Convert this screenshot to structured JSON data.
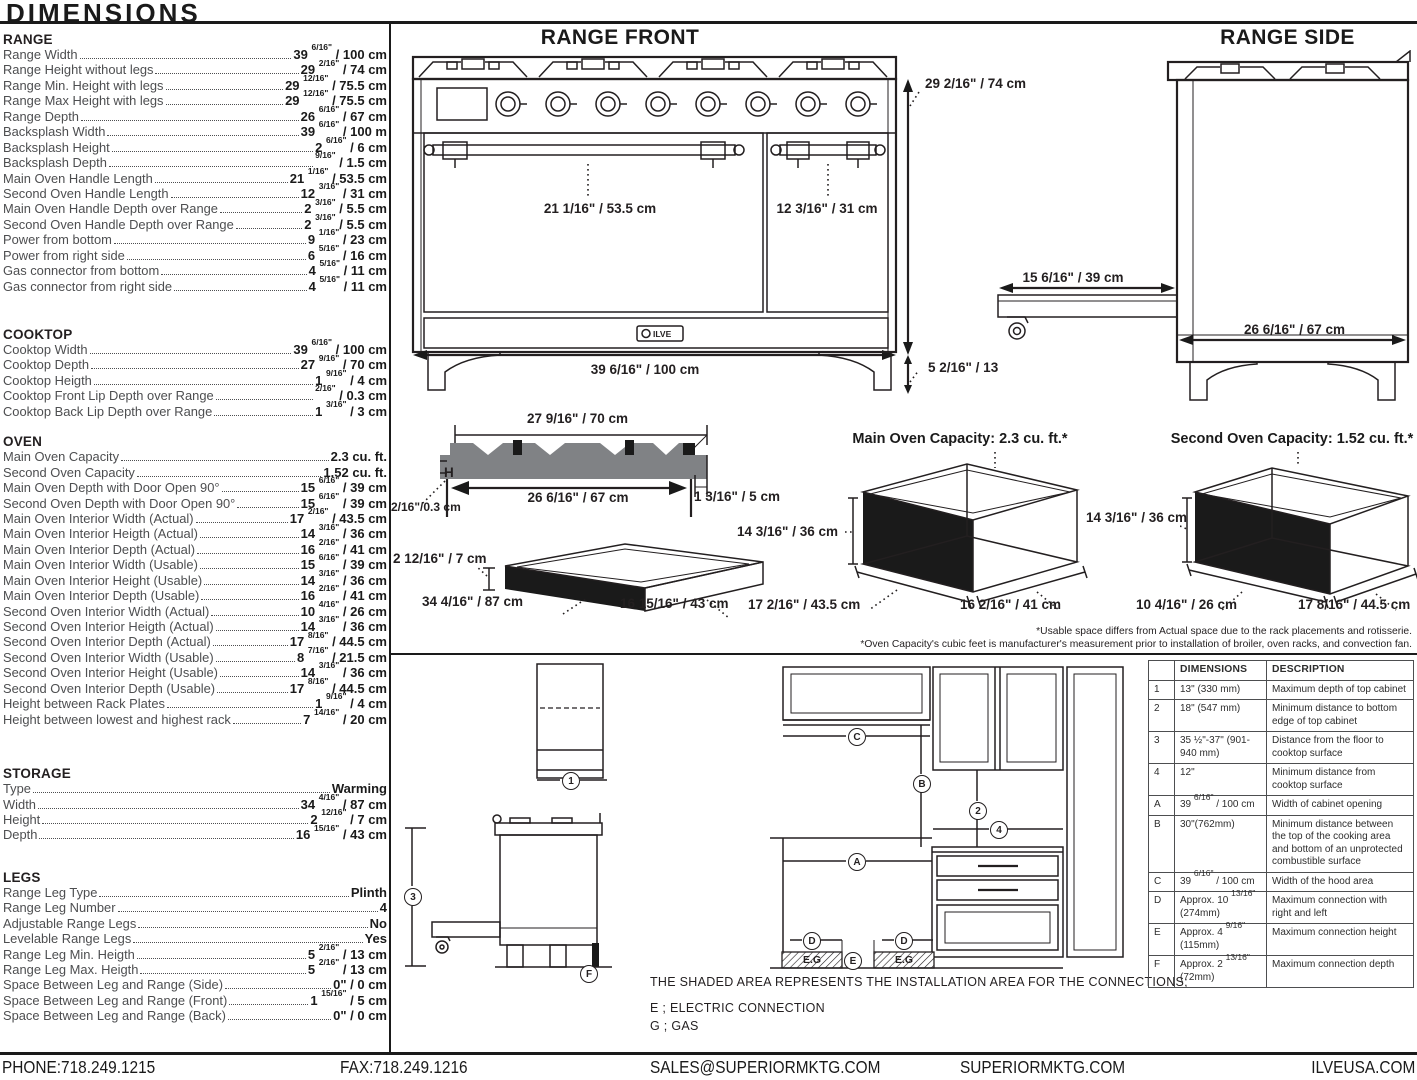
{
  "page_title": "DIMENSIONS",
  "colors": {
    "ink": "#231f20",
    "gray": "#58595b",
    "mid_gray": "#808285"
  },
  "logo": "ILVE",
  "sections": [
    {
      "heading": "RANGE",
      "rows": [
        [
          "Range Width",
          "39 6/16\" / 100 cm"
        ],
        [
          "Range Height without legs",
          "29 2/16\" / 74 cm"
        ],
        [
          "Range Min. Height with legs",
          "29 12/16\" / 75.5 cm"
        ],
        [
          "Range Max Height with legs",
          "29 12/16\" / 75.5 cm"
        ],
        [
          "Range Depth",
          "26 6/16\" / 67 cm"
        ],
        [
          "Backsplash Width",
          "39 6/16\" / 100 m"
        ],
        [
          "Backsplash Height",
          "2 6/16\" / 6 cm"
        ],
        [
          "Backsplash Depth",
          "9/16\" / 1.5 cm"
        ],
        [
          "Main Oven Handle Length",
          "21 1/16\" / 53.5 cm"
        ],
        [
          "Second Oven Handle Length",
          "12 3/16\" / 31 cm"
        ],
        [
          "Main Oven Handle Depth over Range",
          "2 3/16\" / 5.5 cm"
        ],
        [
          "Second Oven Handle Depth over Range",
          "2 3/16\" / 5.5 cm"
        ],
        [
          "Power from bottom",
          "9 1/16\" / 23 cm"
        ],
        [
          "Power from right side",
          "6 5/16\" / 16 cm"
        ],
        [
          "Gas connector from bottom",
          "4 5/16\" / 11 cm"
        ],
        [
          "Gas connector from right side",
          "4 5/16\" / 11 cm"
        ]
      ]
    },
    {
      "heading": "COOKTOP",
      "rows": [
        [
          "Cooktop Width",
          "39 6/16\" / 100 cm"
        ],
        [
          "Cooktop Depth",
          "27 9/16\" / 70 cm"
        ],
        [
          "Cooktop Heigth",
          "1 9/16\" / 4 cm"
        ],
        [
          "Cooktop Front Lip Depth over Range",
          "2/16\" / 0.3 cm"
        ],
        [
          "Cooktop Back Lip Depth over Range",
          "1 3/16\" / 3 cm"
        ]
      ]
    },
    {
      "heading": "OVEN",
      "rows": [
        [
          "Main Oven Capacity",
          "2.3 cu. ft."
        ],
        [
          "Second Oven Capacity",
          "1.52 cu. ft."
        ],
        [
          "Main Oven Depth with Door Open 90°",
          "15 6/16\" / 39 cm"
        ],
        [
          "Second Oven Depth with Door Open 90°",
          "15 6/16\" / 39 cm"
        ],
        [
          "Main Oven Interior Width (Actual)",
          "17 2/16\" / 43.5 cm"
        ],
        [
          "Main Oven Interior Heigth (Actual)",
          "14 3/16\" / 36 cm"
        ],
        [
          "Main Oven Interior Depth (Actual)",
          "16 2/16\" / 41 cm"
        ],
        [
          "Main Oven Interior Width (Usable)",
          "15 6/16\" / 39 cm"
        ],
        [
          "Main Oven Interior Height (Usable)",
          "14 3/16\" / 36 cm"
        ],
        [
          "Main Oven Interior Depth (Usable)",
          "16 2/16\" / 41 cm"
        ],
        [
          "Second Oven Interior Width (Actual)",
          "10 4/16\" / 26 cm"
        ],
        [
          "Second Oven Interior Heigth (Actual)",
          "14 3/16\" / 36 cm"
        ],
        [
          "Second Oven Interior Depth (Actual)",
          "17 8/16\" / 44.5 cm"
        ],
        [
          "Second Oven Interior Width (Usable)",
          "8 7/16\" / 21.5 cm"
        ],
        [
          "Second Oven Interior Height (Usable)",
          "14 3/16\" / 36 cm"
        ],
        [
          "Second Oven Interior Depth (Usable)",
          "17 8/16\" / 44.5 cm"
        ],
        [
          "Height between Rack Plates",
          "1 9/16\" / 4 cm"
        ],
        [
          "Height between lowest and highest rack",
          "7 14/16\" / 20 cm"
        ]
      ]
    },
    {
      "heading": "STORAGE",
      "rows": [
        [
          "Type",
          "Warming"
        ],
        [
          "Width",
          "34 4/16\" / 87 cm"
        ],
        [
          "Height",
          "2 12/16\" / 7 cm"
        ],
        [
          "Depth",
          "16 15/16\" / 43 cm"
        ]
      ]
    },
    {
      "heading": "LEGS",
      "rows": [
        [
          "Range Leg Type",
          "Plinth"
        ],
        [
          "Range Leg Number",
          "4"
        ],
        [
          "Adjustable Range Legs",
          "No"
        ],
        [
          "Levelable Range Legs",
          "Yes"
        ],
        [
          "Range Leg Min. Heigth",
          "5 2/16\" / 13 cm"
        ],
        [
          "Range Leg Max. Heigth",
          "5 2/16\" / 13 cm"
        ],
        [
          "Space Between Leg and Range (Side)",
          "0\" / 0 cm"
        ],
        [
          "Space Between Leg and Range (Front)",
          "1 15/16\" / 5 cm"
        ],
        [
          "Space Between Leg and Range (Back)",
          "0\" / 0 cm"
        ]
      ]
    }
  ],
  "front": {
    "title": "RANGE FRONT",
    "dim_height": "29 2/16\" / 74 cm",
    "dim_main_handle": "21 1/16\" / 53.5 cm",
    "dim_second_handle": "12 3/16\" / 31 cm",
    "dim_width": "39 6/16\" / 100 cm",
    "dim_leg": "5 2/16\" / 13"
  },
  "side": {
    "title": "RANGE SIDE",
    "dim_door": "15 6/16\" / 39 cm",
    "dim_depth": "26 6/16\" / 67 cm"
  },
  "cook": {
    "dim_top": "27 9/16\" / 70 cm",
    "dim_inner": "26 6/16\" / 67 cm",
    "h_label": "H",
    "dim_front_lip": "2/16\"/0.3 cm",
    "dim_back_lip": "1 3/16\" / 5 cm"
  },
  "drw": {
    "dim_h": "2 12/16\" / 7 cm",
    "dim_w": "34 4/16\" / 87 cm",
    "dim_d": "16 15/16\" / 43 cm"
  },
  "main_oven": {
    "title": "Main Oven Capacity: 2.3 cu. ft.*",
    "dim_h": "14 3/16\" / 36 cm",
    "dim_w": "17 2/16\" / 43.5 cm",
    "dim_d": "16 2/16\" / 41 cm"
  },
  "second_oven": {
    "title": "Second Oven Capacity: 1.52 cu. ft.*",
    "dim_h": "14 3/16\" / 36 cm",
    "dim_w": "10 4/16\" / 26 cm",
    "dim_d": "17 8/16\" / 44.5 cm"
  },
  "footnotes": {
    "line1": "*Usable space differs from Actual space due to the rack placements and rotisserie.",
    "line2": "*Oven Capacity's cubic feet is manufacturer's measurement prior to installation of broiler, oven racks, and convection fan."
  },
  "install": {
    "markers": {
      "n1": "1",
      "n2": "2",
      "n3": "3",
      "n4": "4",
      "a": "A",
      "b": "B",
      "c": "C",
      "d": "D",
      "e": "E",
      "f": "F"
    },
    "shaded_label": "E.G",
    "note1": "THE SHADED AREA REPRESENTS THE INSTALLATION AREA FOR THE CONNECTIONS;",
    "note2": "E ; ELECTRIC CONNECTION",
    "note3": "G ; GAS"
  },
  "table": {
    "headers": [
      "",
      "DIMENSIONS",
      "DESCRIPTION"
    ],
    "rows": [
      [
        "1",
        "13\" (330 mm)",
        "Maximum depth of top cabinet"
      ],
      [
        "2",
        "18\" (547 mm)",
        "Minimum distance to bottom edge of top cabinet"
      ],
      [
        "3",
        "35 ½\"-37\" (901-940 mm)",
        "Distance from the floor to cooktop surface"
      ],
      [
        "4",
        "12\"",
        "Minimum distance from cooktop surface"
      ],
      [
        "A",
        "39 6/16\" / 100 cm",
        "Width of cabinet opening"
      ],
      [
        "B",
        "30\"(762mm)",
        "Minimum distance between the top of the cooking area and bottom of an unprotected combustible surface"
      ],
      [
        "C",
        "39 6/16\" / 100 cm",
        "Width of the hood area"
      ],
      [
        "D",
        "Approx. 10 13/16\" (274mm)",
        "Maximum connection with right and left"
      ],
      [
        "E",
        "Approx. 4 9/16\" (115mm)",
        "Maximum connection height"
      ],
      [
        "F",
        "Approx. 2 13/16\" (72mm)",
        "Maximum connection depth"
      ]
    ]
  },
  "footer": {
    "phone": "PHONE:718.249.1215",
    "fax": "FAX:718.249.1216",
    "email": "SALES@SUPERIORMKTG.COM",
    "site": "SUPERIORMKTG.COM",
    "brand_site": "ILVEUSA.COM"
  }
}
